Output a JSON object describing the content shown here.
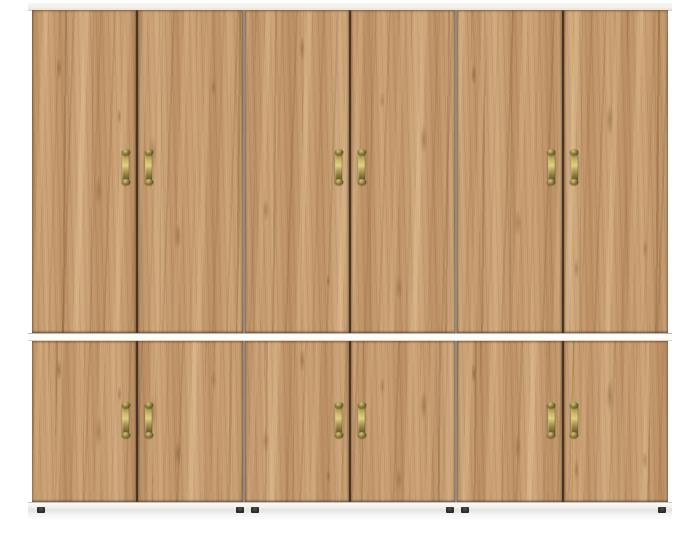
{
  "meta": {
    "type": "product-render",
    "subject": "Two-tier wardrobe with six upper and six lower doors in golden craft-oak finish, brass vertical pull handles, white top board, white middle divider and white plinth with dark feet",
    "background_color": "#ffffff"
  },
  "wardrobe": {
    "colors": {
      "wood_base": "#c59a6e",
      "wood_dark_streak": "#9a6f45",
      "wood_light_streak": "#ddb886",
      "frame_white": "#f3f1ec",
      "divider_white": "#fdfdfc",
      "plinth_white": "#efedea",
      "door_gap": "#42362a",
      "unit_gap": "#8e8c88",
      "handle_brass": "#b3a254",
      "foot_dark": "#2b2926"
    },
    "sections": [
      {
        "id": "upper",
        "label": "upper door row",
        "units": 3,
        "doors_per_unit": 2,
        "door_count": 6,
        "handle_style": "brass vertical pull on inner edge of each door"
      },
      {
        "id": "lower",
        "label": "lower door row",
        "units": 3,
        "doors_per_unit": 2,
        "door_count": 6,
        "handle_style": "brass vertical pull on inner edge of each door"
      }
    ],
    "totals": {
      "doors": 12,
      "handles": 12,
      "feet": 6
    }
  }
}
